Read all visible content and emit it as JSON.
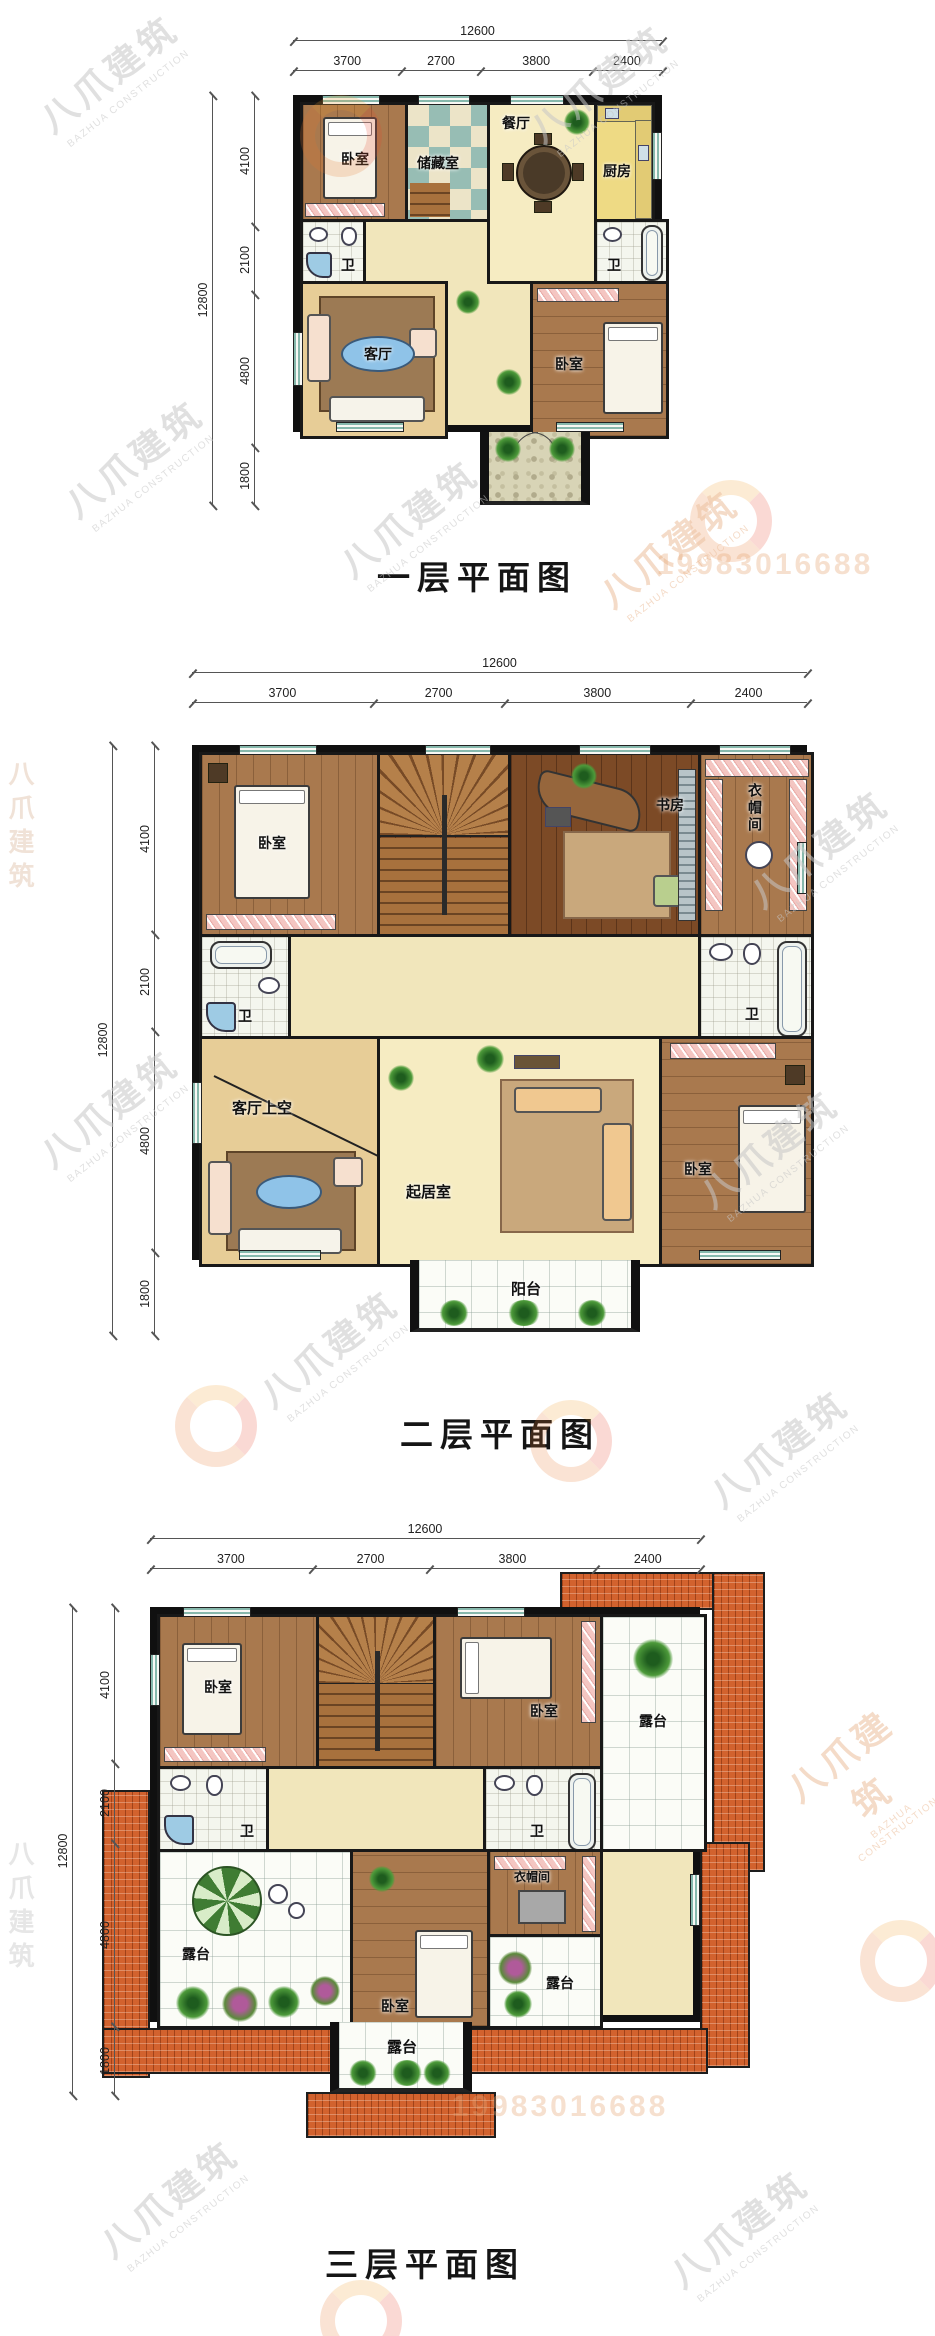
{
  "watermark": {
    "brand_cn": "八爪建筑",
    "brand_en": "BAZHUA CONSTRUCTION",
    "phone": "19983016688"
  },
  "dims": {
    "top_total": "12600",
    "top_segments": [
      "3700",
      "2700",
      "3800",
      "2400"
    ],
    "left_total": "12800",
    "left_segments": [
      "4100",
      "2100",
      "4800",
      "1800"
    ]
  },
  "floor1": {
    "caption": "一层平面图",
    "rooms": {
      "bedroom_tl": "卧室",
      "storage": "储藏室",
      "dining": "餐厅",
      "kitchen": "厨房",
      "bath_left": "卫",
      "bath_right": "卫",
      "living": "客厅",
      "bedroom_br": "卧室"
    }
  },
  "floor2": {
    "caption": "二层平面图",
    "rooms": {
      "bedroom_tl": "卧室",
      "study": "书房",
      "cloakroom": "衣帽间",
      "bath_left": "卫",
      "bath_right": "卫",
      "living_void": "客厅上空",
      "sitting": "起居室",
      "bedroom_br": "卧室",
      "balcony": "阳台"
    }
  },
  "floor3": {
    "caption": "三层平面图",
    "rooms": {
      "bedroom_tl": "卧室",
      "bedroom_tc": "卧室",
      "terrace_tr": "露台",
      "bath_left": "卫",
      "bath_right": "卫",
      "terrace_bl": "露台",
      "bedroom_bc": "卧室",
      "cloakroom": "衣帽间",
      "terrace_br": "露台",
      "terrace_bottom": "露台"
    }
  },
  "colors": {
    "wall": "#101010",
    "floor_cream": "#f1e6bb",
    "wood": "#a9794e",
    "wood_dark": "#7c4a26",
    "storage_teal": "#97bdb4",
    "kitchen_yellow": "#eeda84",
    "tile_white": "#fbfcf7",
    "roof_terracotta": "#d2622e",
    "accent_blue": "#8fc3e8",
    "hatch_pink": "#f4c6c2",
    "watermark_gray": "#c7c7c7",
    "watermark_orange": "#e8a878"
  }
}
